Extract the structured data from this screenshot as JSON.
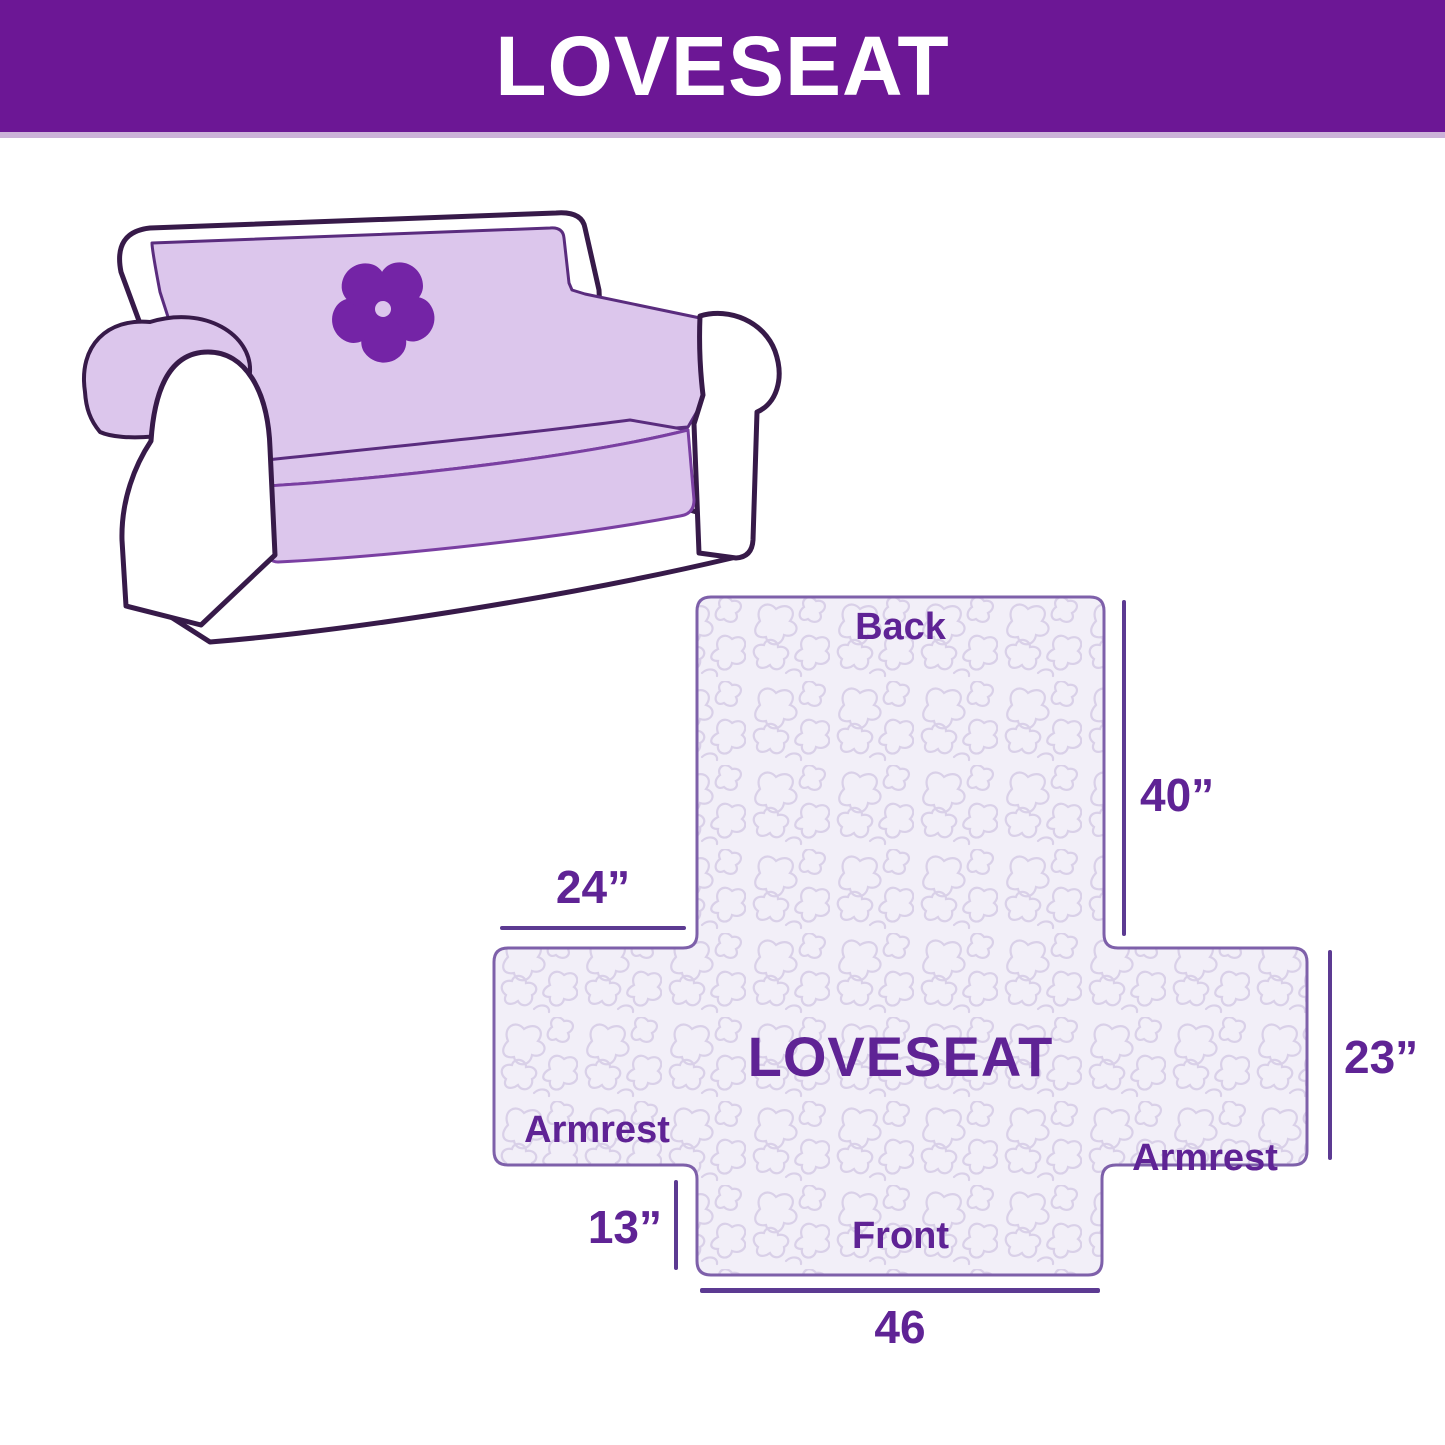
{
  "banner": {
    "title": "LOVESEAT"
  },
  "illustration": {
    "subject": "loveseat sofa with quilted slipcover",
    "logo_icon": "pinwheel-flower-icon"
  },
  "diagram": {
    "back_label": "Back",
    "center_label": "LOVESEAT",
    "armrest_left_label": "Armrest",
    "armrest_right_label": "Armrest",
    "front_label": "Front",
    "dimensions": {
      "back_height": "40”",
      "armrest_top_width": "24”",
      "armrest_height": "23”",
      "front_flap_height": "13”",
      "front_width": "46"
    }
  },
  "colors": {
    "banner_bg": "#6C1795",
    "banner_text": "#FFFFFF",
    "banner_strip": "#CBB2D8",
    "cover_lavender": "#DCC6EC",
    "logo_purple": "#7424A6",
    "outline_dark": "#371A49",
    "quilt_bg": "#F2EFF8",
    "quilt_line": "#D9D0E8",
    "cross_border": "#7E60AA",
    "label_text": "#5F2395",
    "dimension_line": "#5C3A92"
  }
}
